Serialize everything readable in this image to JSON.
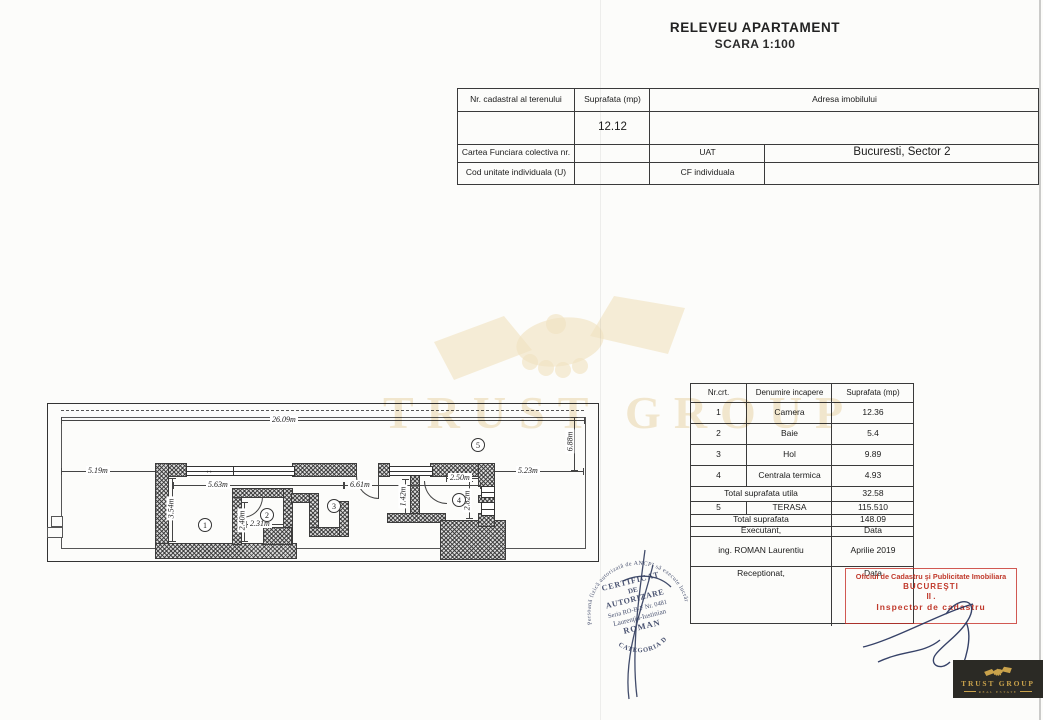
{
  "title": {
    "line1": "RELEVEU APARTAMENT",
    "line2": "SCARA 1:100"
  },
  "top_table": {
    "nr_cadastral_label": "Nr. cadastral al terenului",
    "suprafata_label": "Suprafata (mp)",
    "suprafata_value": "12.12",
    "adresa_label": "Adresa imobilului",
    "cartea_label": "Cartea Funciara colectiva nr.",
    "uat_label": "UAT",
    "uat_value": "Bucuresti, Sector 2",
    "cod_label": "Cod unitate individuala (U)",
    "cf_label": "CF individuala"
  },
  "plan": {
    "dims": {
      "d2609": "26.09m",
      "d688": "6.88m",
      "d519": "5.19m",
      "d523": "5.23m",
      "d563": "5.63m",
      "d661": "6.61m",
      "d250": "2.50m",
      "d354": "3.54m",
      "d240": "2.40m",
      "d231": "2.31m",
      "d142": "1.42m",
      "d282": "2.82m"
    },
    "room_numbers": [
      "1",
      "2",
      "3",
      "4",
      "5"
    ],
    "window_arrow": "↔"
  },
  "room_table": {
    "headers": [
      "Nr.crt.",
      "Denumire incapere",
      "Suprafata (mp)"
    ],
    "rows": [
      {
        "nr": "1",
        "name": "Camera",
        "area": "12.36"
      },
      {
        "nr": "2",
        "name": "Baie",
        "area": "5.4"
      },
      {
        "nr": "3",
        "name": "Hol",
        "area": "9.89"
      },
      {
        "nr": "4",
        "name": "Centrala termica",
        "area": "4.93"
      }
    ],
    "total_utila_label": "Total suprafata utila",
    "total_utila_value": "32.58",
    "terasa": {
      "nr": "5",
      "name": "TERASA",
      "area": "115.510"
    },
    "total_label": "Total suprafata",
    "total_value": "148.09",
    "executant_label": "Executant,",
    "data_label": "Data",
    "executant_value": "ing. ROMAN Laurentiu",
    "data_value": "Aprilie 2019",
    "receptionat_label": "Receptionat,",
    "data_label2": "Data"
  },
  "red_stamp": {
    "line1": "Oficiul de Cadastru şi Publicitate Imobiliara",
    "line2": "BUCUREŞTI",
    "line3": "II .",
    "line4": "Inspector de cadastru",
    "color": "#c0392b"
  },
  "round_stamp": {
    "ring_text": "Persoană fizică autorizată de ANCPI să execute lucrări de cadastru, geodezie şi cartografie",
    "center": [
      "CERTIFICAT",
      "DE",
      "AUTORIZARE",
      "Seria RO-B-F Nr. 0481",
      "Laurenţiu-Iustinian",
      "ROMAN"
    ],
    "bottom": "CATEGORIA D",
    "ink_color": "#4b5472"
  },
  "watermark": {
    "text": "TRUST GROUP"
  },
  "logo": {
    "title": "TRUST GROUP",
    "subtitle": "REAL ESTATE",
    "gold": "#c9a24b"
  }
}
